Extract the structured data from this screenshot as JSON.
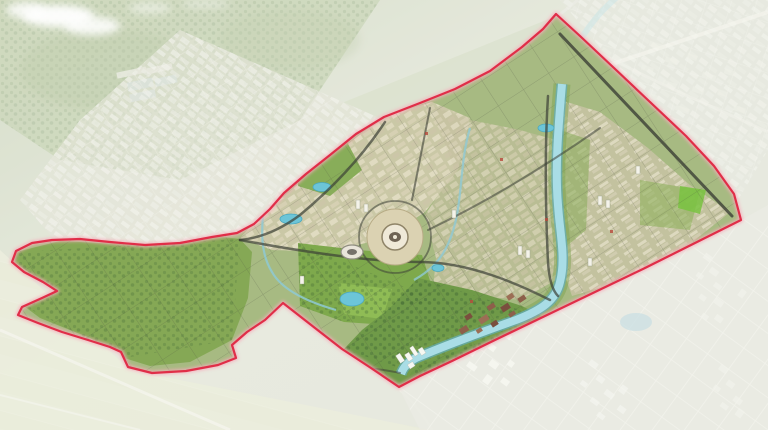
{
  "meta": {
    "title": "Aerial master-plan rendering of urban district outlined by red planning boundary",
    "view": "3D bird's-eye rendering; area outside the red boundary is faded existing city"
  },
  "colors": {
    "boundary_line": "#e02e48",
    "boundary_glow": "#f6aebc",
    "river": "#a9dde6",
    "river_bank": "#62aebe",
    "river_corridor": "#7aa24e",
    "canal": "#8ec9d4",
    "pond": "#6cc5d8",
    "faded_pond": "#c9dfe3",
    "park_green": "#7ea94c",
    "bright_park": "#8fbc55",
    "vivid_park": "#79c23f",
    "west_green": "#85a855",
    "forest_dot": "#3f6b35",
    "interior_base": "#a7ba82",
    "urban_beige": "#cfc9ab",
    "mixed_urban": "#c5c0a0",
    "east_urban": "#c8c3a4",
    "road_dark": "#3c4036",
    "stadium_plaza": "#dbd2b2",
    "stadium_ring": "#efe9d8",
    "stadium_core": "#6e6354",
    "arena_shell": "#e9e5da",
    "building_brown": "#8d5f4a",
    "building_white": "#f7f8f2",
    "hills_green": "#bccaa4",
    "fields_pale": "#e6e8d2",
    "fade_overlay": "#ffffff",
    "cloud_white": "#ffffff"
  },
  "features": {
    "boundary": "planning area boundary (red line)",
    "river": "river corridor through the plan",
    "central_stadium": "central circular stadium plaza",
    "secondary_arena": "secondary oval arena",
    "central_park": "central parkland",
    "clouds": "clouds over north-west hills",
    "surroundings": "faded existing cityscape"
  }
}
